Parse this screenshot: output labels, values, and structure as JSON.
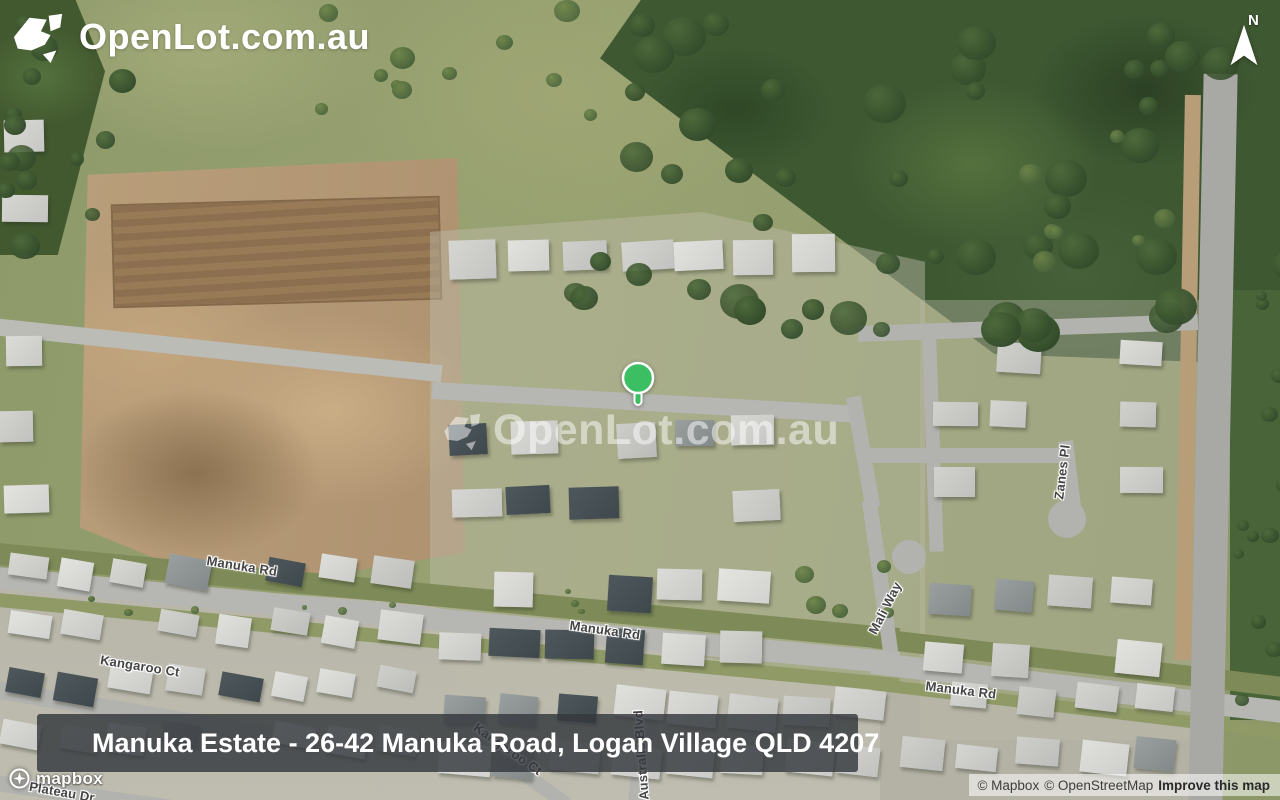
{
  "brand": {
    "logo_text": "OpenLot.com.au"
  },
  "compass": {
    "north_label": "N"
  },
  "watermark": {
    "text": "OpenLot.com.au"
  },
  "marker": {
    "color": "#3CBE63"
  },
  "caption": {
    "text": "Manuka Estate - 26-42 Manuka Road, Logan Village QLD 4207"
  },
  "mapbox_logo": {
    "text": "mapbox"
  },
  "attribution": {
    "mapbox": "© Mapbox",
    "openstreetmap": "© OpenStreetMap",
    "improve": "Improve this map"
  },
  "street_labels": [
    {
      "text": "Manuka Rd",
      "cx": 242,
      "cy": 566,
      "rot": 9
    },
    {
      "text": "Manuka Rd",
      "cx": 605,
      "cy": 630,
      "rot": 8
    },
    {
      "text": "Manuka Rd",
      "cx": 961,
      "cy": 690,
      "rot": 7
    },
    {
      "text": "Kangaroo Ct",
      "cx": 140,
      "cy": 666,
      "rot": 9
    },
    {
      "text": "Kangaroo Ct",
      "cx": 508,
      "cy": 749,
      "rot": 35,
      "layer": "under"
    },
    {
      "text": "Zanes Pl",
      "cx": 1062,
      "cy": 472,
      "rot": -83
    },
    {
      "text": "Mali Way",
      "cx": 885,
      "cy": 608,
      "rot": -63
    },
    {
      "text": "Australis Blvd",
      "cx": 641,
      "cy": 755,
      "rot": -94,
      "layer": "under"
    },
    {
      "text": "Plateau Dr",
      "cx": 62,
      "cy": 792,
      "rot": 10,
      "layer": "under"
    }
  ],
  "colors": {
    "marker_green": "#3CBE63",
    "caption_bg": "#363A40",
    "street_label_text": "#454545",
    "road_gray": "#B2B2AE",
    "dirt_brown": "#B59C79",
    "forest_green": "#3E5832"
  }
}
